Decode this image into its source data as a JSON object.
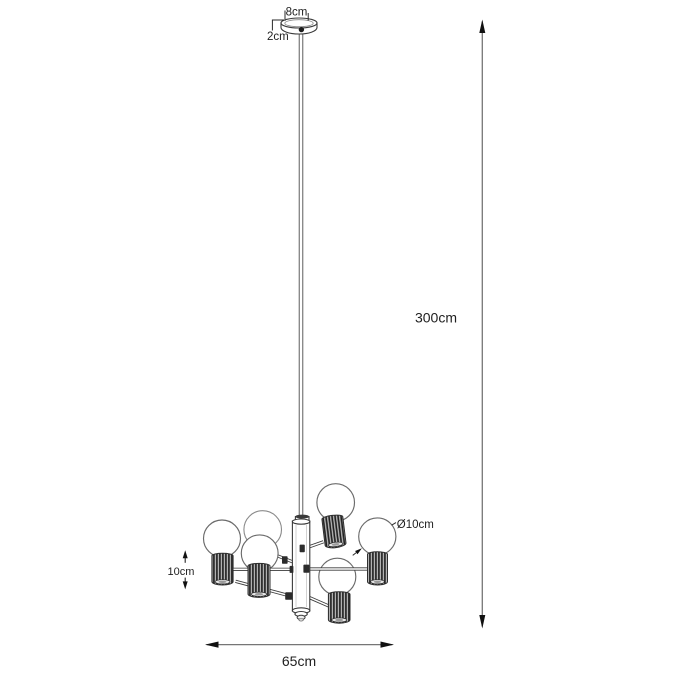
{
  "diagram": {
    "subject": "pendant-chandelier-dimension-drawing",
    "labels": {
      "canopy_width": "8cm",
      "canopy_height": "2cm",
      "suspension_length": "300cm",
      "bulb_diameter": "Ø10cm",
      "socket_height": "10cm",
      "fixture_width": "65cm"
    },
    "colors": {
      "background": "#ffffff",
      "line": "#3a3a3a",
      "dimension_text": "#1f1f1f",
      "socket_fill": "#4a4a4a"
    }
  }
}
